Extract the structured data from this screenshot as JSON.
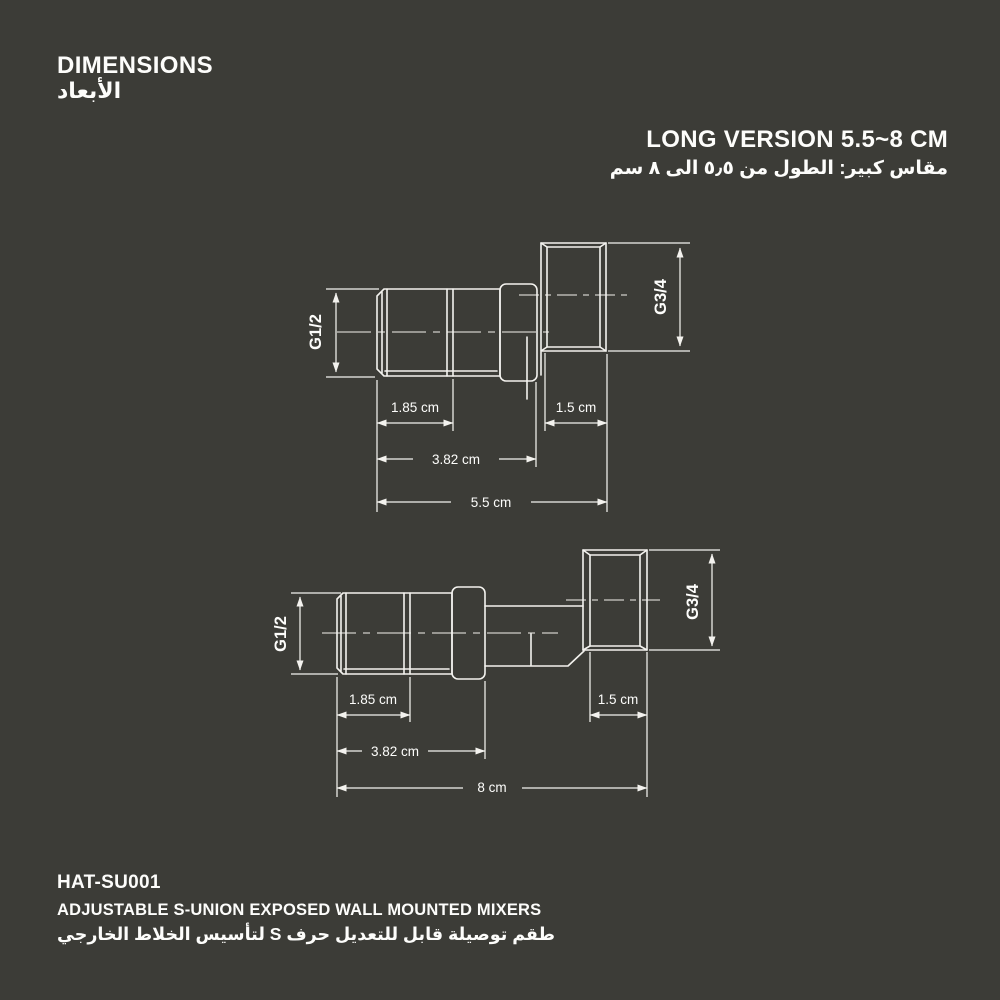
{
  "theme": {
    "background": "#3c3c37",
    "line": "#f3f2ee",
    "text": "#fdfdfb"
  },
  "header": {
    "title_en": "DIMENSIONS",
    "title_ar": "الأبعاد",
    "variant_en": "LONG VERSION 5.5~8 CM",
    "variant_ar": "مقاس كبير: الطول من ٥٫٥ الى ٨ سم"
  },
  "footer": {
    "model": "HAT-SU001",
    "product_en": "ADJUSTABLE S-UNION EXPOSED WALL MOUNTED MIXERS",
    "product_ar": "طقم توصيلة قابل للتعديل حرف S لتأسيس الخلاط الخارجي"
  },
  "drawings": {
    "short": {
      "inlet_thread": "G1/2",
      "outlet_thread": "G3/4",
      "thread_length": "1.85 cm",
      "nut_width": "1.5 cm",
      "body_length": "3.82 cm",
      "overall_length": "5.5 cm"
    },
    "long": {
      "inlet_thread": "G1/2",
      "outlet_thread": "G3/4",
      "thread_length": "1.85 cm",
      "nut_width": "1.5 cm",
      "body_length": "3.82 cm",
      "overall_length": "8 cm"
    }
  }
}
